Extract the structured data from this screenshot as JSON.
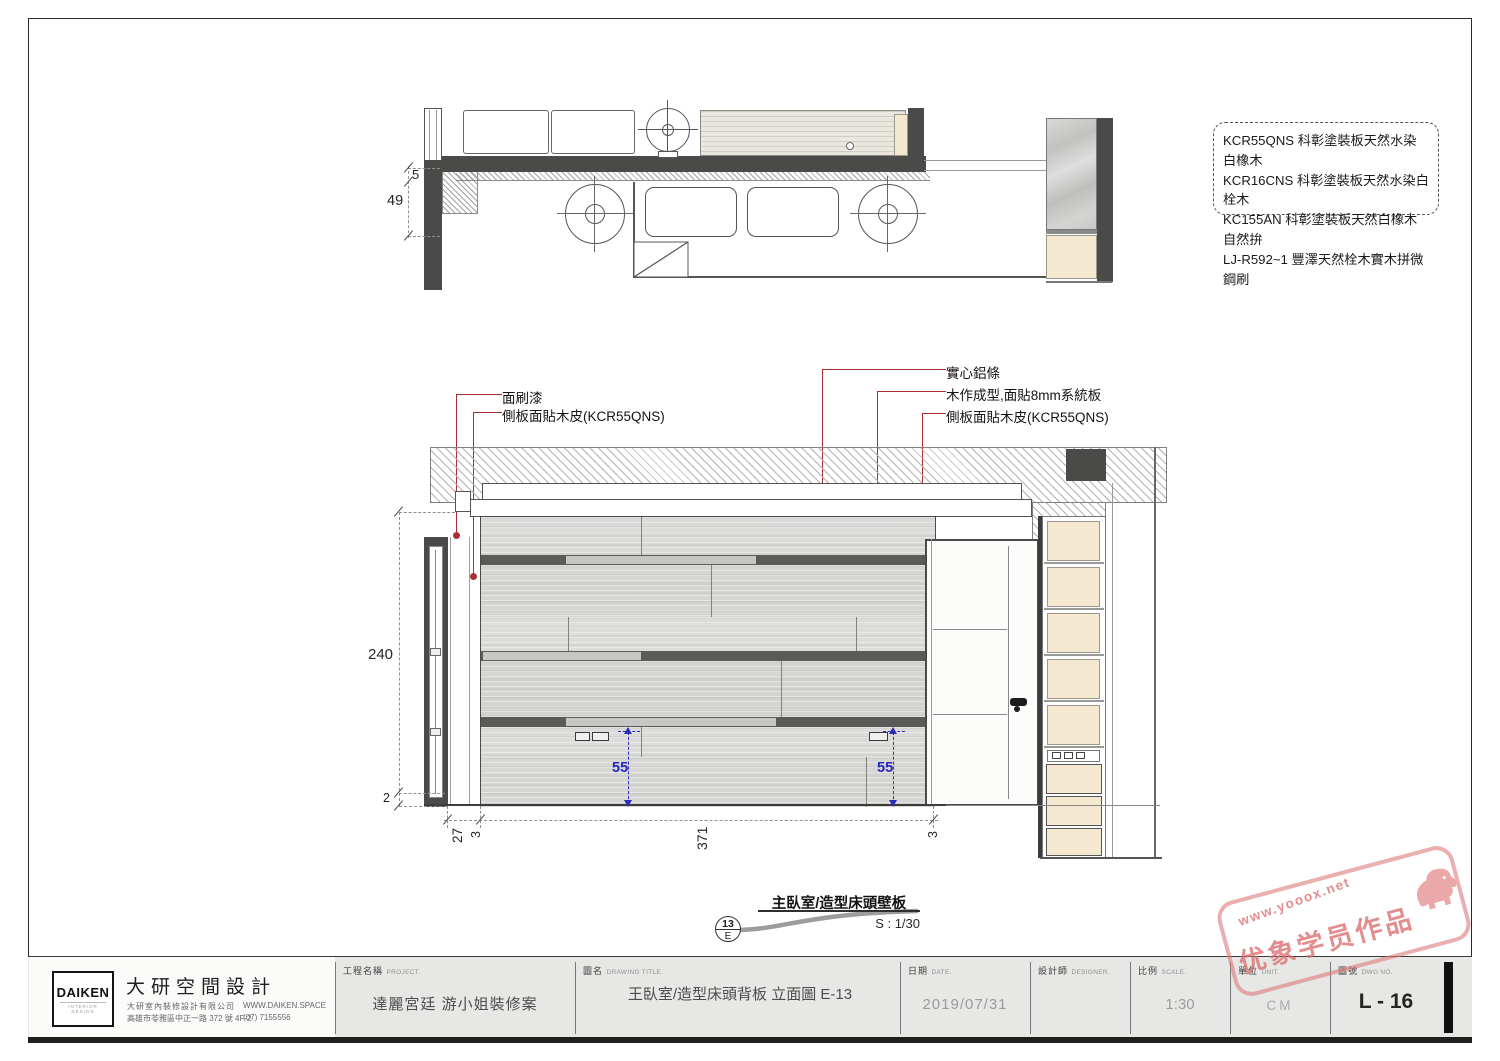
{
  "notes": {
    "lines": [
      "KCR55QNS 科彰塗裝板天然水染白橡木",
      "KCR16CNS 科彰塗裝板天然水染白栓木",
      "KC155AN 科彰塗裝板天然白橡木自然拚",
      "LJ-R592~1 豐澤天然栓木實木拼微鋼刷"
    ]
  },
  "callouts": {
    "paint": "面刷漆",
    "side_veneer_left": "側板面貼木皮(KCR55QNS)",
    "aluminum": "實心鋁條",
    "system_board": "木作成型,面貼8mm系統板",
    "side_veneer_right": "側板面貼木皮(KCR55QNS)"
  },
  "dims": {
    "plan_top": "5",
    "plan_depth": "49",
    "wall_height": "240",
    "base": "2",
    "left_offset": "27",
    "edge_left": "3",
    "wall_width": "371",
    "edge_right": "3",
    "outlet_height_left": "55",
    "outlet_height_right": "55"
  },
  "view_ref": {
    "number": "13",
    "zone": "E",
    "title": "主臥室/造型床頭壁板",
    "scale": "S : 1/30"
  },
  "watermark": {
    "url": "www.yooox.net",
    "text": "优象学员作品"
  },
  "title_block": {
    "logo_text": "DAIKEN",
    "logo_sub": "INTERIOR DESIGN",
    "company_name": "大研空間設計",
    "company_line1": "大研室內裝修設計有限公司",
    "company_line2": "高雄市苓雅區中正一路 372 號 4F-2",
    "company_web": "WWW.DAIKEN.SPACE",
    "company_tel": "(07) 7155556",
    "fields": [
      {
        "zh": "工程名稱",
        "en": "PROJECT.",
        "value": "達麗宮廷 游小姐裝修案"
      },
      {
        "zh": "圖名",
        "en": "DRAWING TITLE.",
        "value": "王臥室/造型床頭背板 立面圖 E-13"
      },
      {
        "zh": "日期",
        "en": "DATE.",
        "value": "2019/07/31"
      },
      {
        "zh": "設計師",
        "en": "DESIGNER.",
        "value": ""
      },
      {
        "zh": "比例",
        "en": "SCALE.",
        "value": "1:30"
      },
      {
        "zh": "單位",
        "en": "UNIT.",
        "value": "CM"
      },
      {
        "zh": "圖號",
        "en": "DWG NO.",
        "value": "L - 16"
      }
    ]
  }
}
